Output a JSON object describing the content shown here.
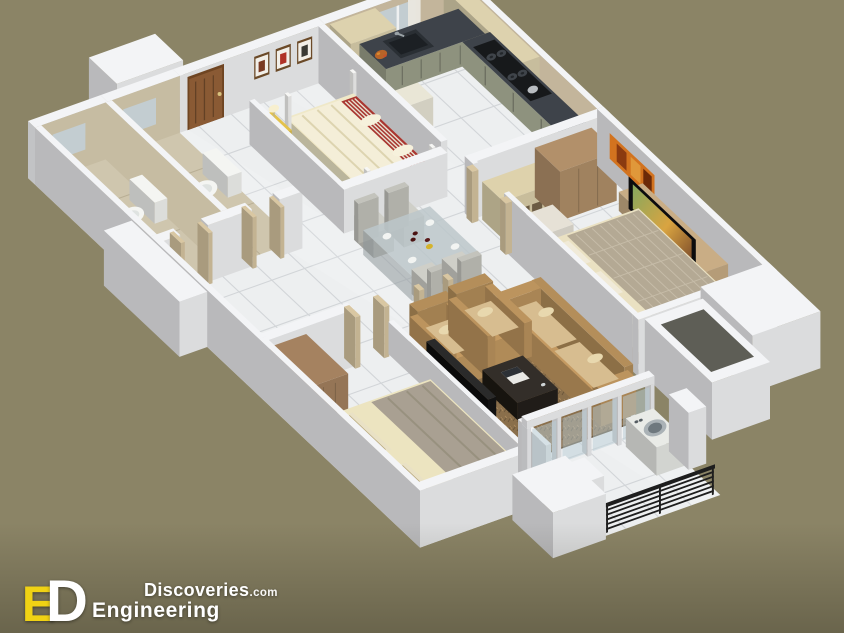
{
  "page": {
    "background": "#8b8466"
  },
  "brand": {
    "monogram_e": "E",
    "monogram_d": "D",
    "discoveries": "Discoveries",
    "tld": ".com",
    "engineering": "Engineering",
    "accent_yellow": "#f0d214",
    "text_white": "#ffffff"
  },
  "scene": {
    "type": "isometric-3d-apartment-floor-plan",
    "rooms": [
      "bathroom-1",
      "bathroom-2",
      "entry-foyer",
      "bedroom-1",
      "kitchen",
      "hall-dining",
      "bedroom-2",
      "living-room",
      "bedroom-3",
      "balcony"
    ],
    "furniture": [
      "four-poster-bed",
      "nightstand",
      "table-lamp",
      "wall-art",
      "entry-door",
      "toilet",
      "wash-basin",
      "kitchen-counter",
      "sink",
      "cooktop",
      "fridge",
      "upper-cabinets",
      "dining-table",
      "dining-chairs",
      "wine-bottles",
      "shelf-unit",
      "wardrobe",
      "desk",
      "desk-chair",
      "tv",
      "tv-stand",
      "wall-painting",
      "sofa",
      "armchairs",
      "coffee-table",
      "laptop",
      "shag-rug",
      "double-bed",
      "washing-machine",
      "glass-doors",
      "balcony-railing",
      "utility-shaft"
    ]
  },
  "palette": {
    "bg": "#8b8466",
    "wall": "#f3f4f6",
    "wall_shadow": "#aeb6c0",
    "floor": "#edeff0",
    "grid": "#d2d5d8",
    "bath_floor": "#cfc6ae",
    "bath_grid": "#b9af95",
    "bath_tile": "#c6bca2",
    "backsplash": "#c3b59b",
    "counter_top": "#3e434a",
    "cabinet_low": "#8e927e",
    "cabinet_up": "#ddd2ae",
    "fridge": "#e9e6d6",
    "wood_door": "#8a5a34",
    "door_frame": "#6f4522",
    "frame_tan": "#d9c7a2",
    "glass": "#c3cdd1",
    "curtain": "#e9e7e0",
    "mattress": "#efe8c8",
    "blanket_red": "#a93631",
    "nightstand": "#e3c24c",
    "bedframe": "#9c7d50",
    "rug_dark": "#2e2d28",
    "shelf": "#ded2ac",
    "wardrobe2": "#b2906a",
    "desk": "#e6e1d6",
    "tv_black": "#0c0c0e",
    "painting": "#d2731f",
    "tv_unit": "#c9ad85",
    "mattress2": "#eae1c2",
    "blanket2": "#b4a994",
    "headboard2": "#8a6a46",
    "sofa": "#c49a62",
    "cushion": "#d7bd90",
    "rug_shag": "#8a6f4b",
    "table_dark": "#332e29",
    "chair_gray": "#cfcfc8",
    "table_glass": "#bcc7ca",
    "wardrobe3": "#a58260",
    "mattress3": "#ece4c0",
    "blanket3": "#a9a092",
    "bedframe3": "#8a6840",
    "washer": "#e9ebe7",
    "railing": "#1e1e1e",
    "glass_door": "#b9cdd6",
    "shaft_hole": "#5e5e56",
    "porcelain": "#f4f5f2",
    "lamp": "#f7efcf"
  }
}
